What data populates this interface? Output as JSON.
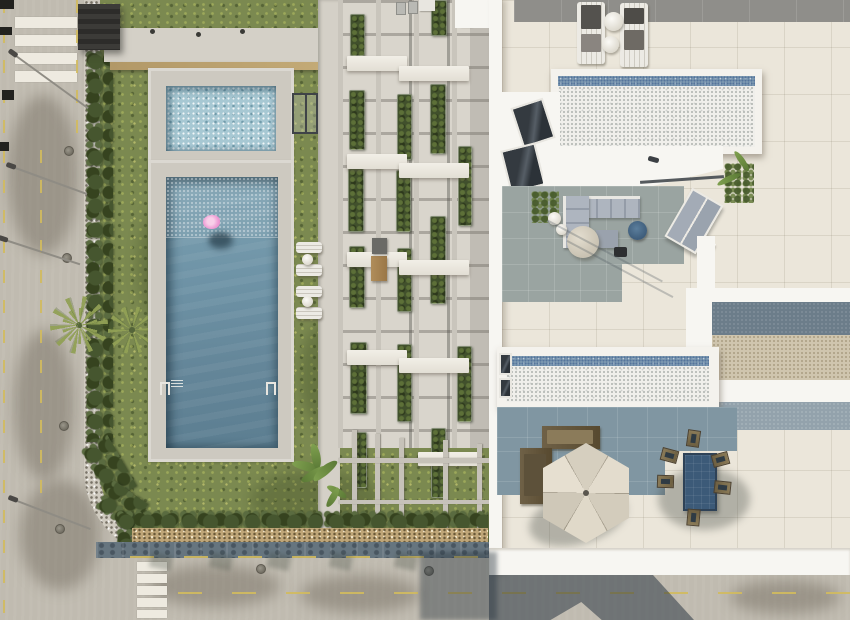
{
  "scene": {
    "type": "aerial-architectural-render",
    "description": "Top-down 3D architectural rendering of a residential complex: a street with crosswalks on the left, a landscaped garden with hedges and palm trees, a communal lap pool with a pink flamingo float plus a kids pool, rows of sun loungers, a central strip of townhouse terraces with pergola beams and planters, and on the right two rooftop solariums with mosaic plunge pools, lounge sofas, a parasol and an outdoor dining set.",
    "objects": {
      "crosswalks": 2,
      "street_lights": 4,
      "manholes": 6,
      "palm_trees": 2,
      "community_pool": 1,
      "kids_pool": 1,
      "flamingo_float": 1,
      "garden_sun_loungers": 4,
      "rooftop_pools": 2,
      "rooftop_sun_loungers": 2,
      "outdoor_sofa_sets": 1,
      "double_sunbed": 1,
      "parasol": 1,
      "dining_table": 1,
      "dining_chairs": 6,
      "wooden_benches": 2,
      "terrace_planters": 17
    },
    "palette": {
      "road": "#c0bbb0",
      "yellow_line": "#d2bb5e",
      "grass": "#7b8950",
      "hedge_green": "#3d4c2b",
      "pool_water": "#6b90a3",
      "kids_pool": "#a7c8d3",
      "flamingo_pink": "#ef9fd6",
      "deck_stone": "#cdc9c0",
      "white_building": "#f7f6f2",
      "cream_tile": "#ebe6da",
      "terrace_blue": "#8096a2",
      "pool_speckle": "#f0efeb",
      "mosaic_strip": "#7d99b1",
      "umbrella": "#ddd6c6",
      "dining_table_top": "#3c5a78",
      "sidewalk": "#66757f"
    }
  }
}
